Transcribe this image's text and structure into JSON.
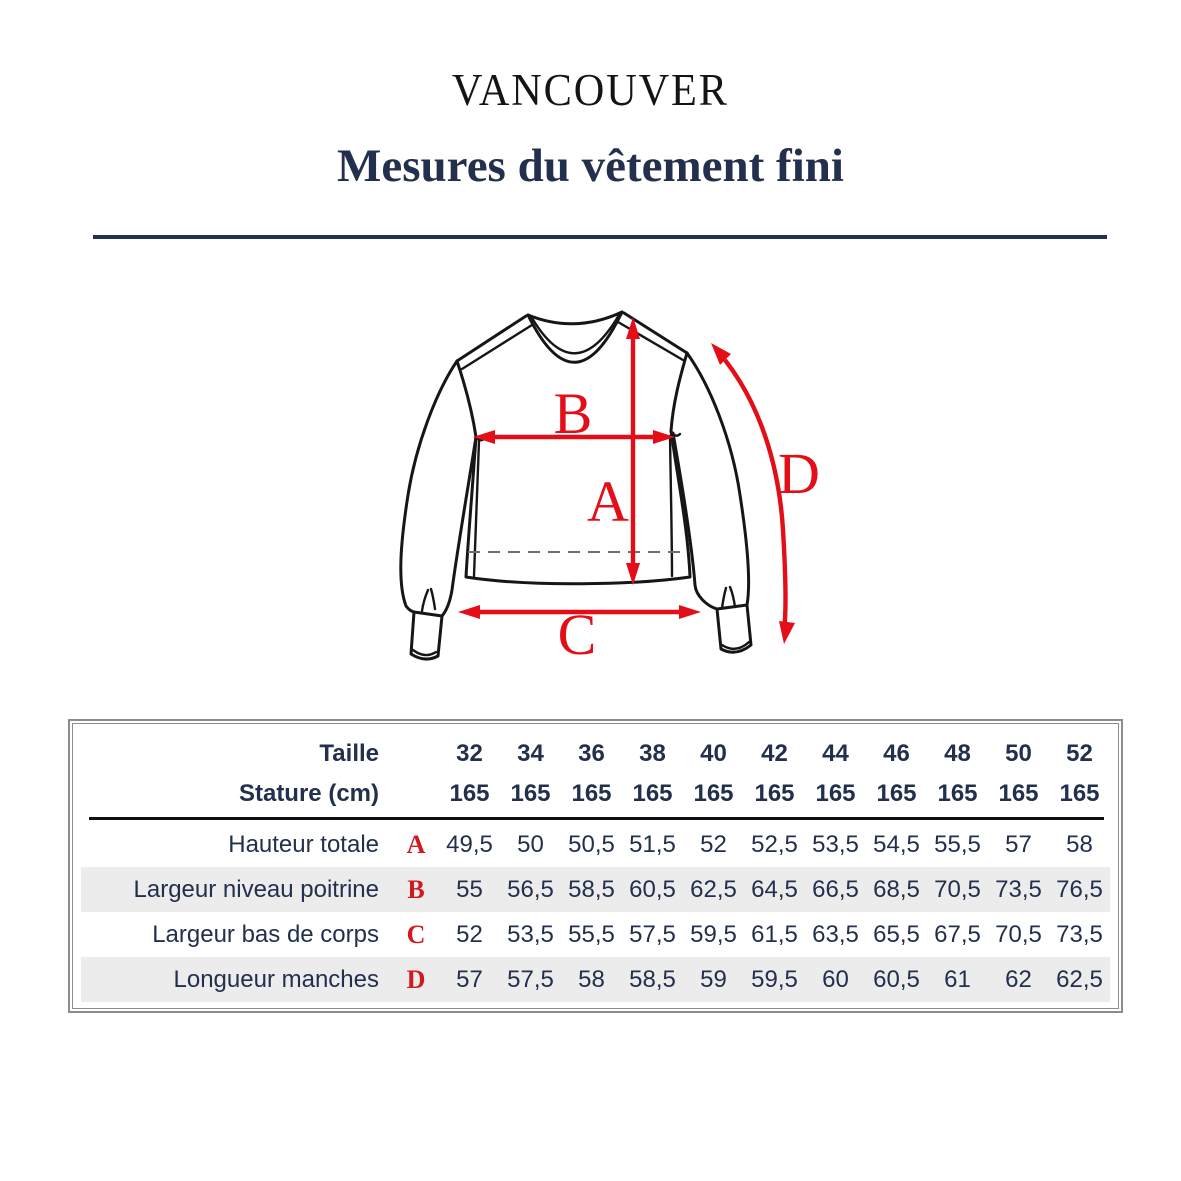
{
  "header": {
    "brand": "VANCOUVER",
    "title": "Mesures du vêtement fini"
  },
  "diagram": {
    "labels": {
      "a": "A",
      "b": "B",
      "c": "C",
      "d": "D"
    }
  },
  "colors": {
    "accent_red": "#e30e18",
    "navy": "#22304e",
    "line_black": "#161616",
    "row_gray": "#ececec",
    "border_gray": "#8c8c8c"
  },
  "size_table": {
    "header_rows": [
      {
        "label": "Taille",
        "values": [
          "32",
          "34",
          "36",
          "38",
          "40",
          "42",
          "44",
          "46",
          "48",
          "50",
          "52"
        ]
      },
      {
        "label": "Stature (cm)",
        "values": [
          "165",
          "165",
          "165",
          "165",
          "165",
          "165",
          "165",
          "165",
          "165",
          "165",
          "165"
        ]
      }
    ],
    "measure_rows": [
      {
        "label": "Hauteur totale",
        "letter": "A",
        "values": [
          "49,5",
          "50",
          "50,5",
          "51,5",
          "52",
          "52,5",
          "53,5",
          "54,5",
          "55,5",
          "57",
          "58"
        ]
      },
      {
        "label": "Largeur niveau poitrine",
        "letter": "B",
        "values": [
          "55",
          "56,5",
          "58,5",
          "60,5",
          "62,5",
          "64,5",
          "66,5",
          "68,5",
          "70,5",
          "73,5",
          "76,5"
        ]
      },
      {
        "label": "Largeur bas de corps",
        "letter": "C",
        "values": [
          "52",
          "53,5",
          "55,5",
          "57,5",
          "59,5",
          "61,5",
          "63,5",
          "65,5",
          "67,5",
          "70,5",
          "73,5"
        ]
      },
      {
        "label": "Longueur manches",
        "letter": "D",
        "values": [
          "57",
          "57,5",
          "58",
          "58,5",
          "59",
          "59,5",
          "60",
          "60,5",
          "61",
          "62",
          "62,5"
        ]
      }
    ]
  }
}
